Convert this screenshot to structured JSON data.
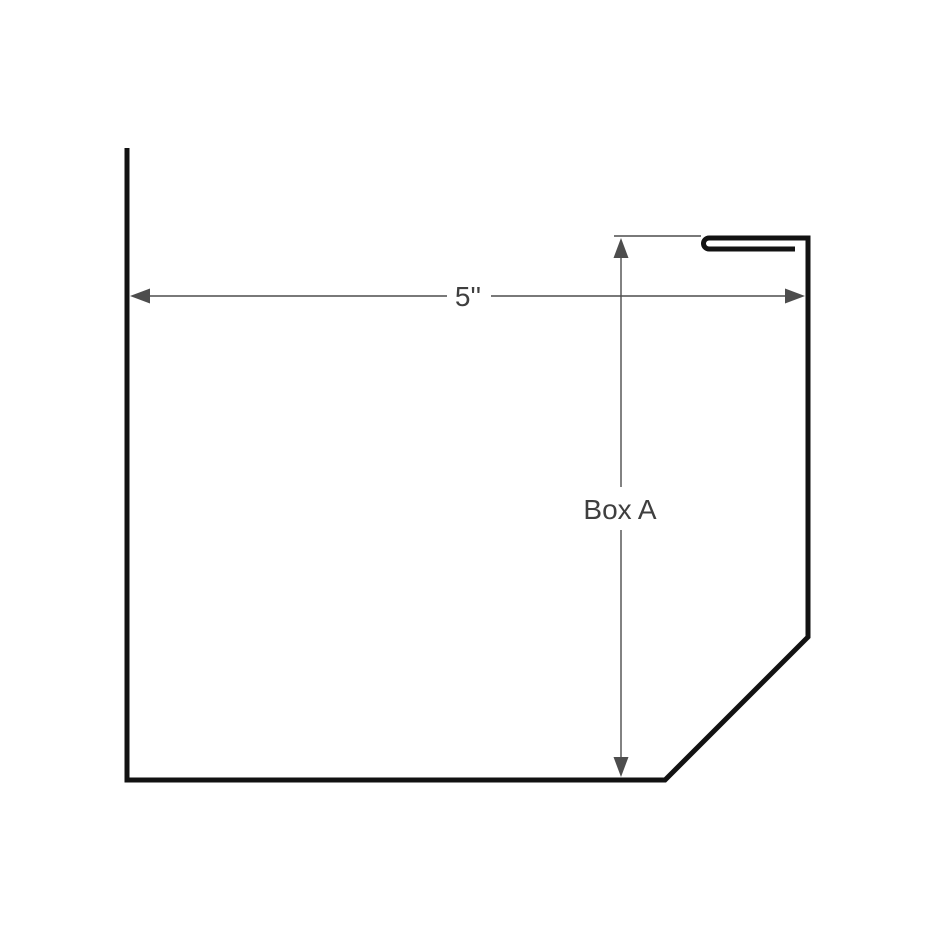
{
  "diagram": {
    "kind": "dimensioned-part-drawing",
    "dimensions": {
      "width": {
        "label": "5''"
      },
      "height": {
        "label": "Box A"
      }
    },
    "colors": {
      "background": "#ffffff",
      "outline_stroke": "#121212",
      "dimension_stroke": "#4d4d4d",
      "label_text": "#3f3f3f"
    }
  }
}
